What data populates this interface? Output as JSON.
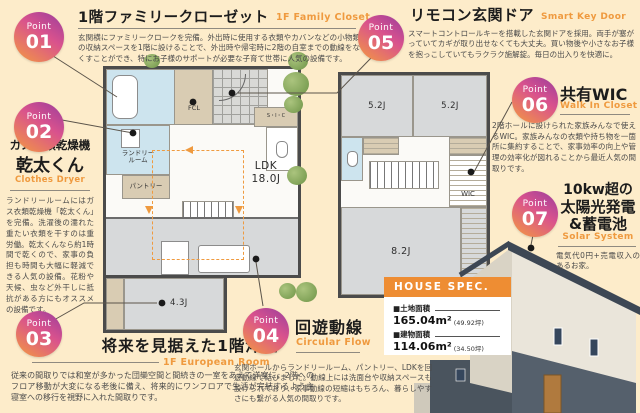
{
  "page": {
    "background": "#fdecca",
    "accent": "#ef9a3f"
  },
  "points": {
    "p01": {
      "label": "Point",
      "num": "01",
      "title": "1階ファミリークローゼット",
      "en": "1F Family Closet",
      "body": "玄関横にファミリークロークを完備。外出時に使用する衣類やカバンなどの小物類の収納スペースを1階に設けることで、外出時や帰宅時に2階の自室までの動線をなくすことができ、特にお子様のサポートが必要な子育て世帯に人気の設備です。"
    },
    "p02": {
      "label": "Point",
      "num": "02",
      "title1": "ガス衣類乾燥機",
      "title2": "乾太くん",
      "en": "Clothes Dryer",
      "body": "ランドリールームにはガス衣類乾燥機「乾太くん」を完備。洗濯後の濡れた重たい衣類を干すのは重労働。乾太くんなら約1時間で乾くので、家事の負担も時間も大幅に軽減できる人気の設備。花粉や天候、虫など外干しに抵抗がある方にもオススメの設備です。"
    },
    "p03": {
      "label": "Point",
      "num": "03",
      "title": "将来を見据えた1階洋室",
      "en": "1F European Room",
      "body": "従来の間取りでは和室が多かった団欒空間と間続きの一室をあえて洋室に。2階へのフロア移動が大変になる老後に備え、将来的にワンフロアで生活が完結するよう主寝室への移行を視野に入れた間取りです。"
    },
    "p04": {
      "label": "Point",
      "num": "04",
      "title": "回遊動線",
      "en": "Circular Flow",
      "body": "玄関ホールからランドリールーム、パントリー、LDKを回遊動線で結びました。動線上には洗面台や収納スペースも設けられており、家事動線の短縮はもちろん、暮らしやすさにも繋がる人気の間取りです。"
    },
    "p05": {
      "label": "Point",
      "num": "05",
      "title": "リモコン玄関ドア",
      "en": "Smart Key Door",
      "body": "スマートコントロールキーを搭載した玄関ドアを採用。両手が塞がっていてカギが取り出せなくても大丈夫。買い物後や小さなお子様を抱っこしていてもラクラク施解錠。毎日の出入りを快適に。"
    },
    "p06": {
      "label": "Point",
      "num": "06",
      "title": "共有WIC",
      "en": "Walk In Closet",
      "body": "2階ホールに設けられた家族みんなで使えるWIC。家族みんなの衣類や持ち物を一箇所に集約することで、家事効率の向上や管理の効率化が図れることから最近人気の間取りです。"
    },
    "p07": {
      "label": "Point",
      "num": "07",
      "title1": "10kw超の",
      "title2": "太陽光発電",
      "title3": "&蓄電池",
      "en": "Solar System",
      "body": "電気代0円+売電収入のあるお家。"
    }
  },
  "floorplan": {
    "f1": {
      "ldk": "LDK",
      "ldk_size": "18.0J",
      "fcl": "FCL",
      "sic": "S・I・C",
      "laundry1": "ランドリー",
      "laundry2": "ルーム",
      "pantry": "パントリー",
      "western_room": "4.3J"
    },
    "f2": {
      "room_a": "5.2J",
      "room_b": "5.2J",
      "wic": "WIC",
      "room_c": "8.2J"
    }
  },
  "house_spec": {
    "header": "HOUSE SPEC.",
    "land_label": "■土地面積",
    "land_value": "165.04m²",
    "land_tsubo": "(49.92坪)",
    "building_label": "■建物面積",
    "building_value": "114.06m²",
    "building_tsubo": "(34.50坪)"
  }
}
